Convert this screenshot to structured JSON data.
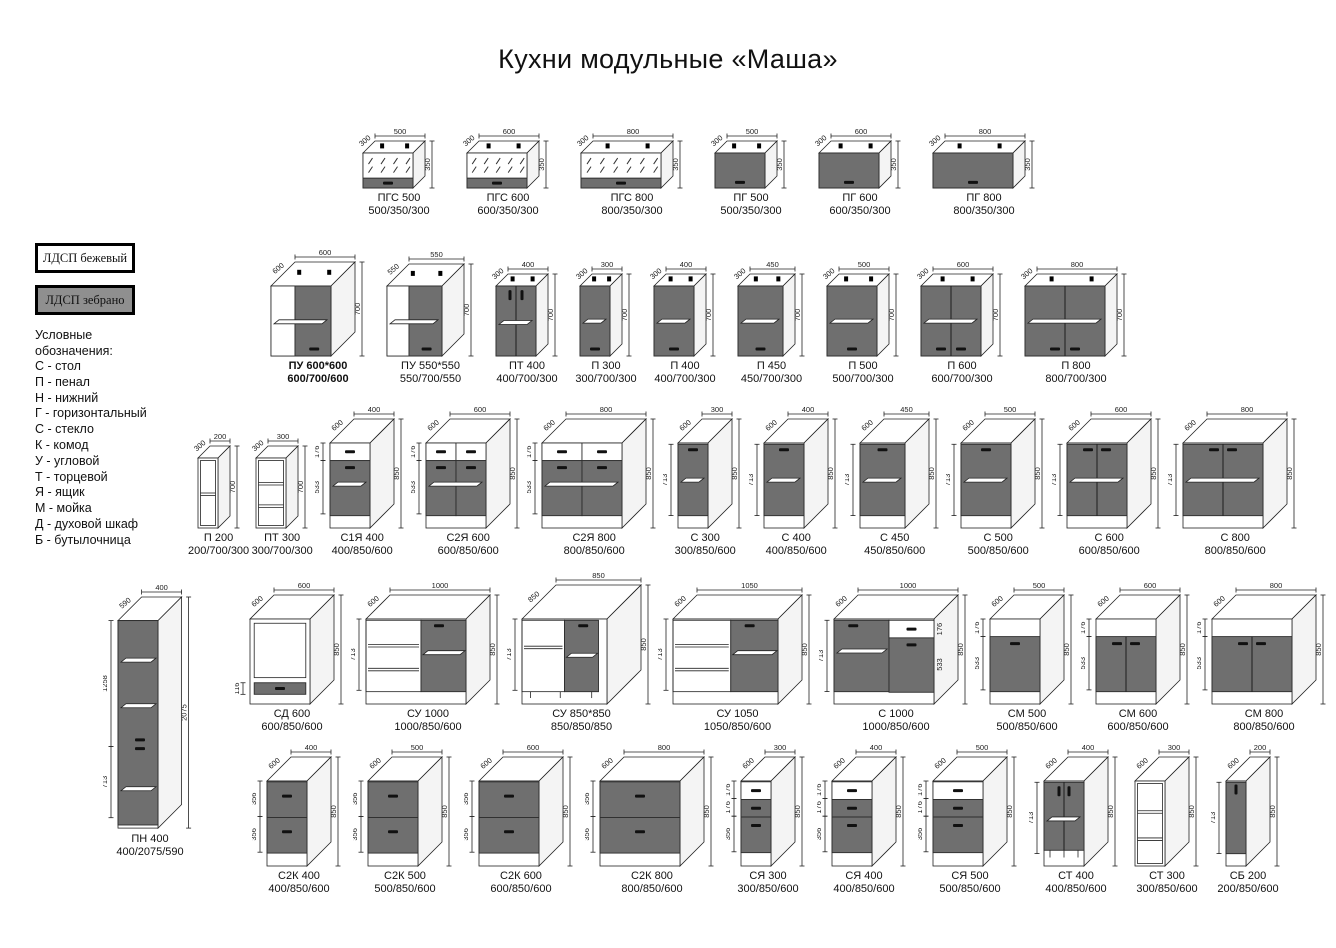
{
  "title": "Кухни модульные «Маша»",
  "legend": {
    "materials": [
      {
        "label": "ЛДСП бежевый",
        "swatch": "#ffffff"
      },
      {
        "label": "ЛДСП зебрано",
        "swatch": "#8f8f8f"
      }
    ],
    "heading": "Условные обозначения:",
    "items": [
      "С - стол",
      "П - пенал",
      "Н - нижний",
      "Г - горизонтальный",
      "С - стекло",
      "К - комод",
      "У - угловой",
      "Т - торцевой",
      "Я - ящик",
      "М - мойка",
      "Д - духовой шкаф",
      "Б - бутылочница"
    ]
  },
  "colors": {
    "front_dark": "#6f6f6f",
    "front_light": "#ffffff",
    "line": "#222222",
    "swatch_zebrano": "#8f8f8f"
  },
  "rows": [
    {
      "cabinets": [
        {
          "name": "ПГС 500",
          "size": "500/350/300",
          "w": 500,
          "h": 350,
          "d": 300,
          "kind": "glass_h"
        },
        {
          "name": "ПГС 600",
          "size": "600/350/300",
          "w": 600,
          "h": 350,
          "d": 300,
          "kind": "glass_h"
        },
        {
          "name": "ПГС 800",
          "size": "800/350/300",
          "w": 800,
          "h": 350,
          "d": 300,
          "kind": "glass_h"
        },
        {
          "name": "ПГ 500",
          "size": "500/350/300",
          "w": 500,
          "h": 350,
          "d": 300,
          "kind": "dark_h"
        },
        {
          "name": "ПГ 600",
          "size": "600/350/300",
          "w": 600,
          "h": 350,
          "d": 300,
          "kind": "dark_h"
        },
        {
          "name": "ПГ 800",
          "size": "800/350/300",
          "w": 800,
          "h": 350,
          "d": 300,
          "kind": "dark_h"
        }
      ]
    },
    {
      "cabinets": [
        {
          "name": "ПУ 600*600",
          "size": "600/700/600",
          "w": 600,
          "h": 700,
          "d": 600,
          "kind": "corner_wall",
          "bold": true
        },
        {
          "name": "ПУ 550*550",
          "size": "550/700/550",
          "w": 550,
          "h": 700,
          "d": 550,
          "kind": "corner_wall"
        },
        {
          "name": "ПТ 400",
          "size": "400/700/300",
          "w": 400,
          "h": 700,
          "d": 300,
          "kind": "twodoor_t"
        },
        {
          "name": "П 300",
          "size": "300/700/300",
          "w": 300,
          "h": 700,
          "d": 300,
          "kind": "door_b"
        },
        {
          "name": "П 400",
          "size": "400/700/300",
          "w": 400,
          "h": 700,
          "d": 300,
          "kind": "door_b"
        },
        {
          "name": "П 450",
          "size": "450/700/300",
          "w": 450,
          "h": 700,
          "d": 300,
          "kind": "door_b"
        },
        {
          "name": "П 500",
          "size": "500/700/300",
          "w": 500,
          "h": 700,
          "d": 300,
          "kind": "door_b"
        },
        {
          "name": "П 600",
          "size": "600/700/300",
          "w": 600,
          "h": 700,
          "d": 300,
          "kind": "doors2_b"
        },
        {
          "name": "П 800",
          "size": "800/700/300",
          "w": 800,
          "h": 700,
          "d": 300,
          "kind": "doors2_b"
        }
      ]
    },
    {
      "cabinets": [
        {
          "name": "П 200",
          "size": "200/700/300",
          "w": 200,
          "h": 700,
          "d": 300,
          "kind": "open2"
        },
        {
          "name": "ПТ 300",
          "size": "300/700/300",
          "w": 300,
          "h": 700,
          "d": 300,
          "kind": "open3"
        },
        {
          "name": "С1Я 400",
          "size": "400/850/600",
          "w": 400,
          "h": 850,
          "d": 600,
          "kind": "drawer_door",
          "sub": [
            176,
            533
          ]
        },
        {
          "name": "С2Я 600",
          "size": "600/850/600",
          "w": 600,
          "h": 850,
          "d": 600,
          "kind": "drawer2_door2",
          "sub": [
            176,
            533
          ]
        },
        {
          "name": "С2Я 800",
          "size": "800/850/600",
          "w": 800,
          "h": 850,
          "d": 600,
          "kind": "drawer2_door2",
          "sub": [
            176,
            533
          ]
        },
        {
          "name": "С 300",
          "size": "300/850/600",
          "w": 300,
          "h": 850,
          "d": 600,
          "kind": "door_t",
          "sub": [
            713
          ]
        },
        {
          "name": "С 400",
          "size": "400/850/600",
          "w": 400,
          "h": 850,
          "d": 600,
          "kind": "door_t",
          "sub": [
            713
          ]
        },
        {
          "name": "С 450",
          "size": "450/850/600",
          "w": 450,
          "h": 850,
          "d": 600,
          "kind": "door_t",
          "sub": [
            713
          ]
        },
        {
          "name": "С 500",
          "size": "500/850/600",
          "w": 500,
          "h": 850,
          "d": 600,
          "kind": "door_t",
          "sub": [
            713
          ]
        },
        {
          "name": "С 600",
          "size": "600/850/600",
          "w": 600,
          "h": 850,
          "d": 600,
          "kind": "doors2_t",
          "sub": [
            713
          ]
        },
        {
          "name": "С 800",
          "size": "800/850/600",
          "w": 800,
          "h": 850,
          "d": 600,
          "kind": "doors2_t",
          "sub": [
            713
          ]
        }
      ]
    },
    {
      "cabinets": [
        {
          "name": "СД 600",
          "size": "600/850/600",
          "w": 600,
          "h": 850,
          "d": 600,
          "kind": "oven",
          "sub": [
            116
          ]
        },
        {
          "name": "СУ 1000",
          "size": "1000/850/600",
          "w": 1000,
          "h": 850,
          "d": 600,
          "kind": "corner_open_door",
          "sub": [
            713
          ]
        },
        {
          "name": "СУ 850*850",
          "size": "850/850/850",
          "w": 850,
          "h": 850,
          "d": 850,
          "kind": "corner_base",
          "sub": [
            713
          ]
        },
        {
          "name": "СУ 1050",
          "size": "1050/850/600",
          "w": 1050,
          "h": 850,
          "d": 600,
          "kind": "corner_open_door",
          "sub": [
            713
          ]
        },
        {
          "name": "С 1000",
          "size": "1000/850/600",
          "w": 1000,
          "h": 850,
          "d": 600,
          "kind": "combo_1000",
          "sub": [
            713
          ],
          "subRight": [
            176,
            533
          ]
        },
        {
          "name": "СМ 500",
          "size": "500/850/600",
          "w": 500,
          "h": 850,
          "d": 600,
          "kind": "sink1",
          "sub": [
            176,
            533
          ]
        },
        {
          "name": "СМ 600",
          "size": "600/850/600",
          "w": 600,
          "h": 850,
          "d": 600,
          "kind": "sink2",
          "sub": [
            176,
            533
          ]
        },
        {
          "name": "СМ 800",
          "size": "800/850/600",
          "w": 800,
          "h": 850,
          "d": 600,
          "kind": "sink2",
          "sub": [
            176,
            533
          ]
        }
      ]
    },
    {
      "cabinets": [
        {
          "name": "С2К 400",
          "size": "400/850/600",
          "w": 400,
          "h": 850,
          "d": 600,
          "kind": "drawers2",
          "sub": [
            356,
            356
          ]
        },
        {
          "name": "С2К 500",
          "size": "500/850/600",
          "w": 500,
          "h": 850,
          "d": 600,
          "kind": "drawers2",
          "sub": [
            356,
            356
          ]
        },
        {
          "name": "С2К 600",
          "size": "600/850/600",
          "w": 600,
          "h": 850,
          "d": 600,
          "kind": "drawers2",
          "sub": [
            356,
            356
          ]
        },
        {
          "name": "С2К 800",
          "size": "800/850/600",
          "w": 800,
          "h": 850,
          "d": 600,
          "kind": "drawers2",
          "sub": [
            356,
            356
          ]
        },
        {
          "name": "СЯ 300",
          "size": "300/850/600",
          "w": 300,
          "h": 850,
          "d": 600,
          "kind": "drawers3",
          "sub": [
            176,
            176,
            356
          ]
        },
        {
          "name": "СЯ 400",
          "size": "400/850/600",
          "w": 400,
          "h": 850,
          "d": 600,
          "kind": "drawers3",
          "sub": [
            176,
            176,
            356
          ]
        },
        {
          "name": "СЯ 500",
          "size": "500/850/600",
          "w": 500,
          "h": 850,
          "d": 600,
          "kind": "drawers3",
          "sub": [
            176,
            176,
            356
          ]
        },
        {
          "name": "СТ 400",
          "size": "400/850/600",
          "w": 400,
          "h": 850,
          "d": 600,
          "kind": "end_doors",
          "sub": [
            713
          ]
        },
        {
          "name": "СТ 300",
          "size": "300/850/600",
          "w": 300,
          "h": 850,
          "d": 600,
          "kind": "open3"
        },
        {
          "name": "СБ 200",
          "size": "200/850/600",
          "w": 200,
          "h": 850,
          "d": 600,
          "kind": "bottle",
          "sub": [
            713
          ]
        }
      ]
    }
  ],
  "tall_cabinet": {
    "name": "ПН 400",
    "size": "400/2075/590",
    "w": 400,
    "h": 2075,
    "d": 590,
    "kind": "tall",
    "sub": [
      1258,
      713
    ]
  }
}
